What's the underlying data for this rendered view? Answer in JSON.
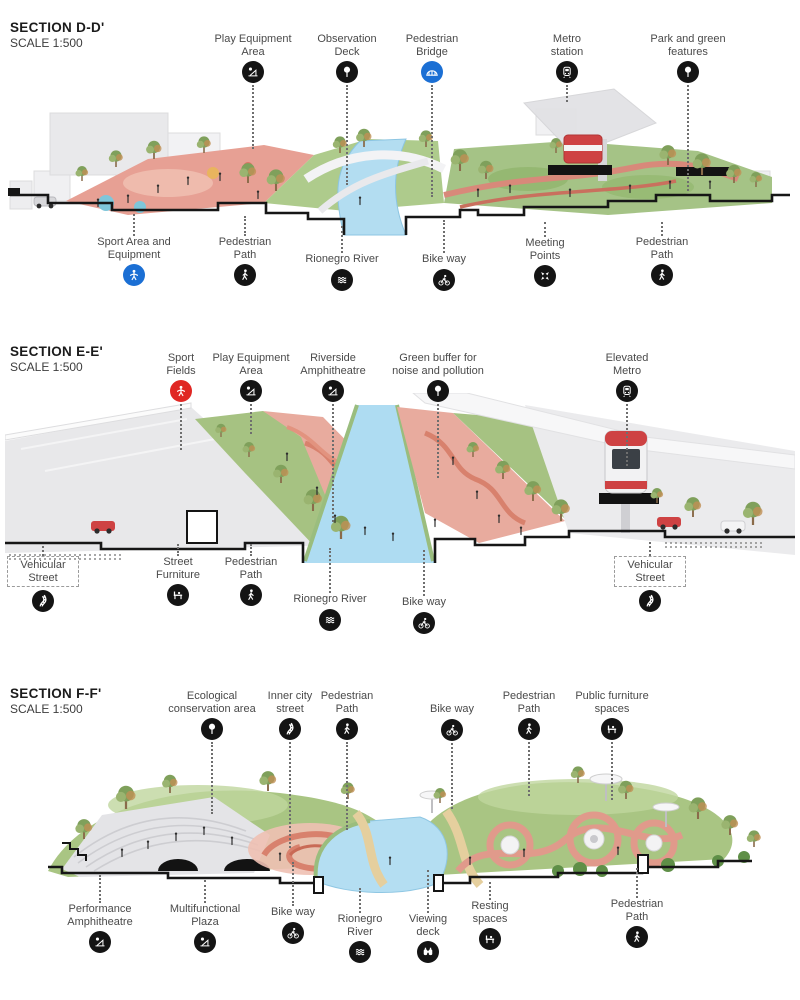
{
  "palette": {
    "icon_black": "#141414",
    "icon_blue": "#1b6fd4",
    "icon_red": "#e02723",
    "river_blue": "#b3ddf1",
    "park_green": "#a6c282",
    "path_pink": "#e8ab9e",
    "tram_red": "#ce4243",
    "building_gray": "#e9e9eb"
  },
  "sections": [
    {
      "title": "SECTION D-D'",
      "scale": "SCALE 1:500",
      "labels": [
        {
          "text": [
            "Play Equipment",
            "Area"
          ],
          "icon": "playground",
          "variant": "black",
          "pos": "top",
          "x": 253,
          "y": 33,
          "leader": 64
        },
        {
          "text": [
            "Observation",
            "Deck"
          ],
          "icon": "tree",
          "variant": "black",
          "pos": "top",
          "x": 347,
          "y": 33,
          "leader": 100
        },
        {
          "text": [
            "Pedestrian",
            "Bridge"
          ],
          "icon": "bridge",
          "variant": "blue",
          "pos": "top",
          "x": 432,
          "y": 33,
          "leader": 112
        },
        {
          "text": [
            "Metro",
            "station"
          ],
          "icon": "train",
          "variant": "black",
          "pos": "top",
          "x": 567,
          "y": 33,
          "leader": 17
        },
        {
          "text": [
            "Park and green",
            "features"
          ],
          "icon": "tree",
          "variant": "black",
          "pos": "top",
          "x": 688,
          "y": 33,
          "leader": 106
        },
        {
          "text": [
            "Sport Area and",
            "Equipment"
          ],
          "icon": "sport-person",
          "variant": "blue",
          "pos": "bottom",
          "x": 134,
          "y": 214,
          "leader": 22
        },
        {
          "text": [
            "Pedestrian",
            "Path"
          ],
          "icon": "walk",
          "variant": "black",
          "pos": "bottom",
          "x": 245,
          "y": 216,
          "leader": 20
        },
        {
          "text": [
            "Rionegro River"
          ],
          "icon": "waves",
          "variant": "black",
          "pos": "bottom",
          "x": 342,
          "y": 226,
          "leader": 27
        },
        {
          "text": [
            "Bike way"
          ],
          "icon": "bike",
          "variant": "black",
          "pos": "bottom",
          "x": 444,
          "y": 220,
          "leader": 33
        },
        {
          "text": [
            "Meeting",
            "Points"
          ],
          "icon": "meeting",
          "variant": "black",
          "pos": "bottom",
          "x": 545,
          "y": 222,
          "leader": 15
        },
        {
          "text": [
            "Pedestrian",
            "Path"
          ],
          "icon": "walk",
          "variant": "black",
          "pos": "bottom",
          "x": 662,
          "y": 222,
          "leader": 14
        }
      ]
    },
    {
      "title": "SECTION E-E'",
      "scale": "SCALE 1:500",
      "labels": [
        {
          "text": [
            "Sport",
            "Fields"
          ],
          "icon": "sport-person",
          "variant": "red",
          "pos": "top",
          "x": 181,
          "y": 352,
          "leader": 46
        },
        {
          "text": [
            "Play Equipment",
            "Area"
          ],
          "icon": "playground",
          "variant": "black",
          "pos": "top",
          "x": 251,
          "y": 352,
          "leader": 30
        },
        {
          "text": [
            "Riverside",
            "Amphitheatre"
          ],
          "icon": "playground",
          "variant": "black",
          "pos": "top",
          "x": 333,
          "y": 352,
          "leader": 118
        },
        {
          "text": [
            "Green buffer for",
            "noise and pollution"
          ],
          "icon": "tree",
          "variant": "black",
          "pos": "top",
          "x": 438,
          "y": 352,
          "leader": 74
        },
        {
          "text": [
            "Elevated",
            "Metro"
          ],
          "icon": "train",
          "variant": "black",
          "pos": "top",
          "x": 627,
          "y": 352,
          "leader": 62
        },
        {
          "text": [
            "Vehicular",
            "Street"
          ],
          "icon": "car-road",
          "variant": "black",
          "pos": "bottom",
          "x": 43,
          "y": 546,
          "leader": 10,
          "boxed": true
        },
        {
          "text": [
            "Street",
            "Furniture"
          ],
          "icon": "bench",
          "variant": "black",
          "pos": "bottom",
          "x": 178,
          "y": 544,
          "leader": 12
        },
        {
          "text": [
            "Pedestrian",
            "Path"
          ],
          "icon": "walk",
          "variant": "black",
          "pos": "bottom",
          "x": 251,
          "y": 544,
          "leader": 12
        },
        {
          "text": [
            "Rionegro River"
          ],
          "icon": "waves",
          "variant": "black",
          "pos": "bottom",
          "x": 330,
          "y": 548,
          "leader": 45
        },
        {
          "text": [
            "Bike way"
          ],
          "icon": "bike",
          "variant": "black",
          "pos": "bottom",
          "x": 424,
          "y": 550,
          "leader": 46
        },
        {
          "text": [
            "Vehicular",
            "Street"
          ],
          "icon": "car-road",
          "variant": "black",
          "pos": "bottom",
          "x": 650,
          "y": 542,
          "leader": 14,
          "boxed": true
        }
      ]
    },
    {
      "title": "SECTION F-F'",
      "scale": "SCALE 1:500",
      "labels": [
        {
          "text": [
            "Ecological",
            "conservation area"
          ],
          "icon": "tree",
          "variant": "black",
          "pos": "top",
          "x": 212,
          "y": 690,
          "leader": 72
        },
        {
          "text": [
            "Inner city",
            "street"
          ],
          "icon": "car-road",
          "variant": "black",
          "pos": "top",
          "x": 290,
          "y": 690,
          "leader": 106
        },
        {
          "text": [
            "Pedestrian",
            "Path"
          ],
          "icon": "walk",
          "variant": "black",
          "pos": "top",
          "x": 347,
          "y": 690,
          "leader": 88
        },
        {
          "text": [
            "Bike way"
          ],
          "icon": "bike",
          "variant": "black",
          "pos": "top",
          "x": 452,
          "y": 703,
          "leader": 66
        },
        {
          "text": [
            "Pedestrian",
            "Path"
          ],
          "icon": "walk",
          "variant": "black",
          "pos": "top",
          "x": 529,
          "y": 690,
          "leader": 54
        },
        {
          "text": [
            "Public furniture",
            "spaces"
          ],
          "icon": "bench",
          "variant": "black",
          "pos": "top",
          "x": 612,
          "y": 690,
          "leader": 58
        },
        {
          "text": [
            "Performance",
            "Amphitheatre"
          ],
          "icon": "playground",
          "variant": "black",
          "pos": "bottom",
          "x": 100,
          "y": 875,
          "leader": 28
        },
        {
          "text": [
            "Multifunctional",
            "Plaza"
          ],
          "icon": "playground",
          "variant": "black",
          "pos": "bottom",
          "x": 205,
          "y": 880,
          "leader": 23
        },
        {
          "text": [
            "Bike way"
          ],
          "icon": "bike",
          "variant": "black",
          "pos": "bottom",
          "x": 293,
          "y": 862,
          "leader": 44
        },
        {
          "text": [
            "Rionegro",
            "River"
          ],
          "icon": "waves",
          "variant": "black",
          "pos": "bottom",
          "x": 360,
          "y": 888,
          "leader": 25
        },
        {
          "text": [
            "Viewing",
            "deck"
          ],
          "icon": "binoculars",
          "variant": "black",
          "pos": "bottom",
          "x": 428,
          "y": 870,
          "leader": 43
        },
        {
          "text": [
            "Resting",
            "spaces"
          ],
          "icon": "bench",
          "variant": "black",
          "pos": "bottom",
          "x": 490,
          "y": 882,
          "leader": 18
        },
        {
          "text": [
            "Pedestrian",
            "Path"
          ],
          "icon": "walk",
          "variant": "black",
          "pos": "bottom",
          "x": 637,
          "y": 868,
          "leader": 30
        }
      ]
    }
  ]
}
